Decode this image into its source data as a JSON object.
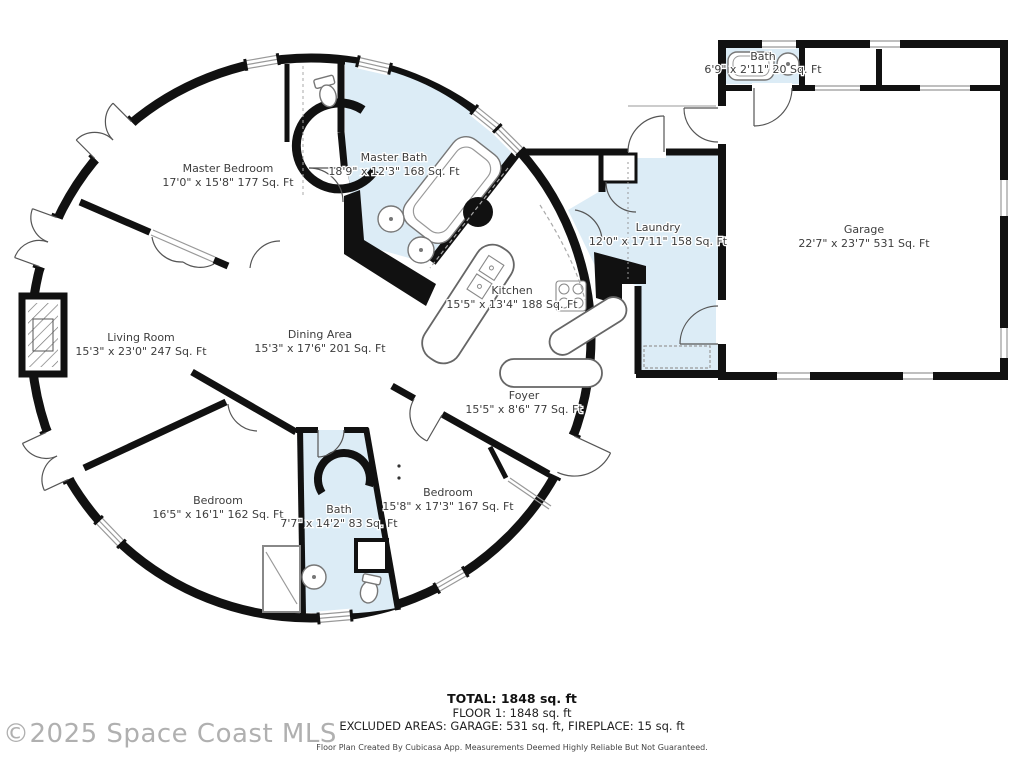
{
  "floorplan": {
    "rooms": {
      "master_bedroom": {
        "name": "Master Bedroom",
        "dims": "17'0\" x 15'8\" 177 Sq. Ft"
      },
      "master_bath": {
        "name": "Master Bath",
        "dims": "18'9\" x 12'3\" 168 Sq. Ft"
      },
      "garage_bath": {
        "name": "Bath",
        "dims": "6'9\" x 2'11\" 20 Sq. Ft"
      },
      "laundry": {
        "name": "Laundry",
        "dims": "12'0\" x 17'11\" 158 Sq. Ft"
      },
      "garage": {
        "name": "Garage",
        "dims": "22'7\" x 23'7\" 531 Sq. Ft"
      },
      "kitchen": {
        "name": "Kitchen",
        "dims": "15'5\" x 13'4\" 188 Sq. Ft"
      },
      "living_room": {
        "name": "Living Room",
        "dims": "15'3\" x 23'0\" 247 Sq. Ft"
      },
      "dining_area": {
        "name": "Dining Area",
        "dims": "15'3\" x 17'6\" 201 Sq. Ft"
      },
      "foyer": {
        "name": "Foyer",
        "dims": "15'5\" x 8'6\" 77 Sq. Ft"
      },
      "bedroom_left": {
        "name": "Bedroom",
        "dims": "16'5\" x 16'1\" 162 Sq. Ft"
      },
      "bath_lower": {
        "name": "Bath",
        "dims": "7'7\" x 14'2\" 83 Sq. Ft"
      },
      "bedroom_right": {
        "name": "Bedroom",
        "dims": "15'8\" x 17'3\" 167 Sq. Ft"
      }
    },
    "summary": {
      "total": "TOTAL: 1848 sq. ft",
      "floor1": "FLOOR 1: 1848 sq. ft",
      "excluded": "EXCLUDED AREAS: GARAGE: 531 sq. ft, FIREPLACE: 15 sq. ft",
      "disclaimer": "Floor Plan Created By Cubicasa App. Measurements Deemed Highly Reliable But Not Guaranteed."
    },
    "watermark": "©2025 Space Coast MLS",
    "colors": {
      "wet_room_fill": "#dcecf6",
      "wall": "#111111",
      "background": "#ffffff"
    }
  }
}
